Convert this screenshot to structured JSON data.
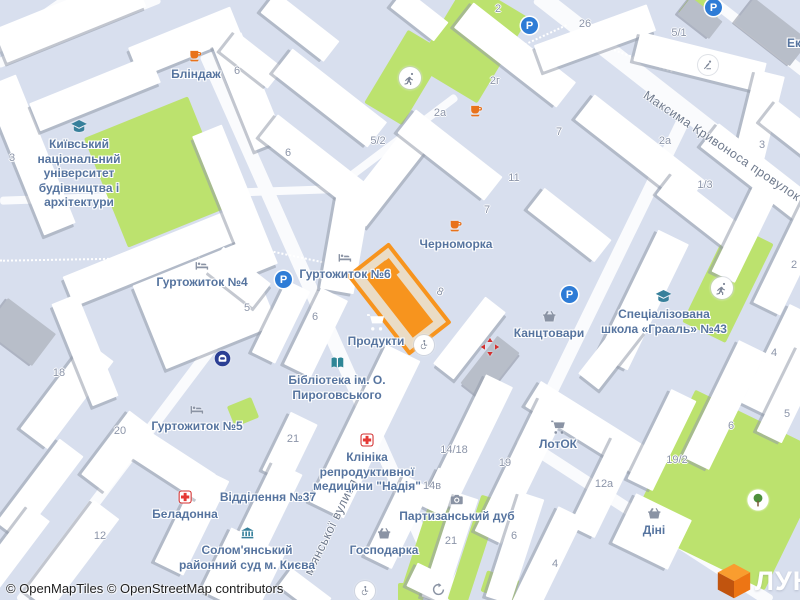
{
  "map": {
    "background": "#D8DFEE",
    "attribution": "© OpenMapTiles © OpenStreetMap contributors"
  },
  "brand": {
    "logo_text": "ЛУН"
  },
  "colors": {
    "selection_border": "#F7941E",
    "selection_fill": "#EADCC6",
    "green_area": "#BCE26E",
    "parking_blue": "#2E7CD6",
    "poi_label": "#56749F",
    "street_label": "#6F7A8D",
    "house_number": "#8C95A9",
    "brand_orange": "#ED7514"
  },
  "streets": {
    "kryvonosa": "Максима Кривоноса провулок",
    "solomianska_partial": "м'янської вулиця"
  },
  "pois": {
    "blindazh": "Бліндаж",
    "university": "Київський\nнаціональний\nуніверситет\nбудівництва і\nархітектури",
    "dorm4": "Гуртожиток №4",
    "dorm6": "Гуртожиток №6",
    "chornomorka": "Черноморка",
    "produkty": "Продукти",
    "kantstovary": "Канцтовари",
    "school": "Спеціалізована\nшкола «Грааль» №43",
    "library": "Бібліотека ім. О.\nПироговського",
    "dorm5": "Гуртожиток №5",
    "clinic": "Клініка\nрепродуктивної\nмедицини \"Надія\"",
    "post_office": "Відділення №37",
    "beladonna": "Беладонна",
    "court": "Солом'янський\nрайонний суд м. Києва",
    "partisan_oak": "Партизанський дуб",
    "hospodarka": "Господарка",
    "lotok": "ЛотОК",
    "dini": "Діні",
    "ek_partial": "Ек"
  },
  "house_numbers": {
    "h3_tl": "3",
    "h6_top": "6",
    "h6_mid": "6",
    "h5_2": "5/2",
    "h2a_left": "2а",
    "h2g": "2г",
    "h26": "26",
    "h2_top": "2",
    "h5_1": "5/1",
    "h11": "11",
    "h7_upper": "7",
    "h7_lower": "7",
    "h2a_right": "2а",
    "h3_tr": "3",
    "h1_3": "1/3",
    "h8": "8",
    "h5_mid": "5",
    "h6_dorm": "6",
    "h18": "18",
    "h20": "20",
    "h21_left": "21",
    "h12": "12",
    "h14_18": "14/18",
    "h19": "19",
    "h14v": "14в",
    "h21_mid": "21",
    "h6_bottom": "6",
    "h2_right": "2",
    "h4_right": "4",
    "h19_2": "19/2",
    "h12a": "12а",
    "h6_right": "6",
    "h5_right": "5",
    "h4_bottom": "4"
  },
  "icons": {
    "parking_letter": "P",
    "legend": {
      "parking-icon": "blue circle with letter P",
      "cafe-icon": "orange coffee cup",
      "bed-icon": "dormitory bed",
      "graduation-cap-icon": "education",
      "running-icon": "sports ground runner",
      "playground-icon": "playground slide",
      "wheelchair-icon": "accessibility",
      "shopping-cart-icon": "supermarket",
      "shopping-basket-icon": "shop",
      "pharmacy-cross-icon": "pharmacy / clinic cross",
      "red-arrows-icon": "medical centre arrows",
      "book-icon": "library",
      "courthouse-icon": "court building",
      "camera-icon": "photo landmark",
      "vehicle-icon": "transport poi",
      "tree-icon": "park tree",
      "recycle-icon": "recycling point",
      "lun-cube-logo": "orange 3d cube"
    }
  }
}
